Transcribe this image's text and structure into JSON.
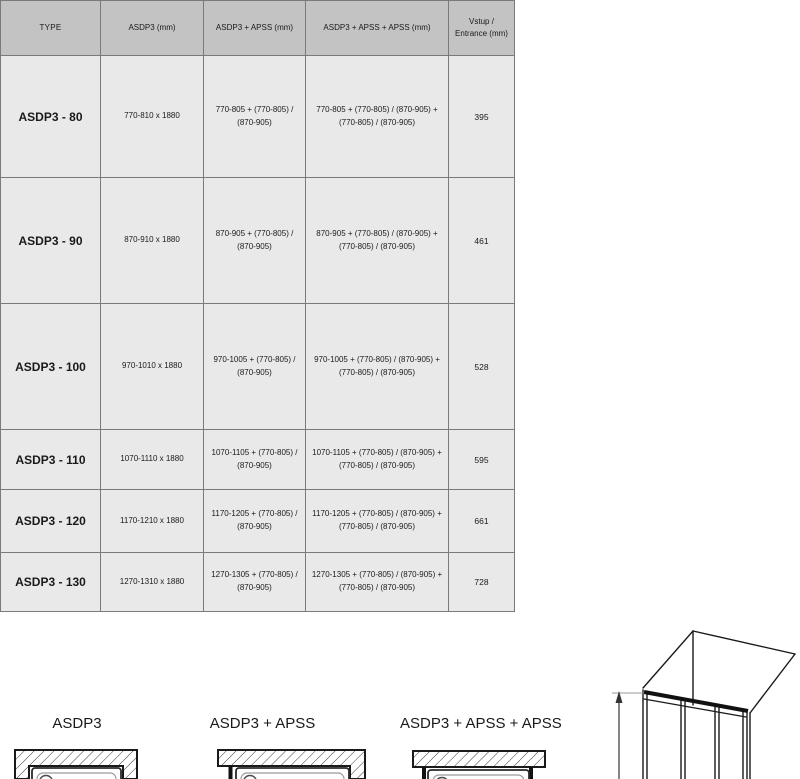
{
  "table": {
    "headers": {
      "type": "TYPE",
      "asdp3": "ASDP3 (mm)",
      "asdp3_apss": "ASDP3 + APSS (mm)",
      "asdp3_apss_apss": "ASDP3 + APSS + APSS (mm)",
      "entrance": "Vstup / Entrance (mm)"
    },
    "rows": [
      {
        "type": "ASDP3 - 80",
        "asdp3": "770-810 x 1880",
        "asdp3_apss": "770-805 + (770-805) / (870-905)",
        "asdp3_apss_apss": "770-805 + (770-805) / (870-905) + (770-805) / (870-905)",
        "entrance": "395"
      },
      {
        "type": "ASDP3 - 90",
        "asdp3": "870-910 x 1880",
        "asdp3_apss": "870-905 + (770-805) / (870-905)",
        "asdp3_apss_apss": "870-905 + (770-805) / (870-905) + (770-805) / (870-905)",
        "entrance": "461"
      },
      {
        "type": "ASDP3 - 100",
        "asdp3": "970-1010 x 1880",
        "asdp3_apss": "970-1005 + (770-805) / (870-905)",
        "asdp3_apss_apss": "970-1005 + (770-805) / (870-905) + (770-805) / (870-905)",
        "entrance": "528"
      },
      {
        "type": "ASDP3 - 110",
        "asdp3": "1070-1110 x 1880",
        "asdp3_apss": "1070-1105 + (770-805) / (870-905)",
        "asdp3_apss_apss": "1070-1105 + (770-805) / (870-905) + (770-805) / (870-905)",
        "entrance": "595"
      },
      {
        "type": "ASDP3 - 120",
        "asdp3": "1170-1210 x 1880",
        "asdp3_apss": "1170-1205 + (770-805) / (870-905)",
        "asdp3_apss_apss": "1170-1205 + (770-805) / (870-905) + (770-805) / (870-905)",
        "entrance": "661"
      },
      {
        "type": "ASDP3 - 130",
        "asdp3": "1270-1310 x 1880",
        "asdp3_apss": "1270-1305 + (770-805) / (870-905)",
        "asdp3_apss_apss": "1270-1305 + (770-805) / (870-905) + (770-805) / (870-905)",
        "entrance": "728"
      }
    ]
  },
  "diagrams": {
    "asdp3_label": "ASDP3",
    "asdp3_apss_label": "ASDP3 + APSS",
    "asdp3_apss_apss_label": "ASDP3 + APSS + APSS"
  },
  "colors": {
    "header_bg": "#c3c3c3",
    "row_bg": "#e9e9e9",
    "grid": "#7a7a7a",
    "line_art": "#1a1a1a"
  }
}
